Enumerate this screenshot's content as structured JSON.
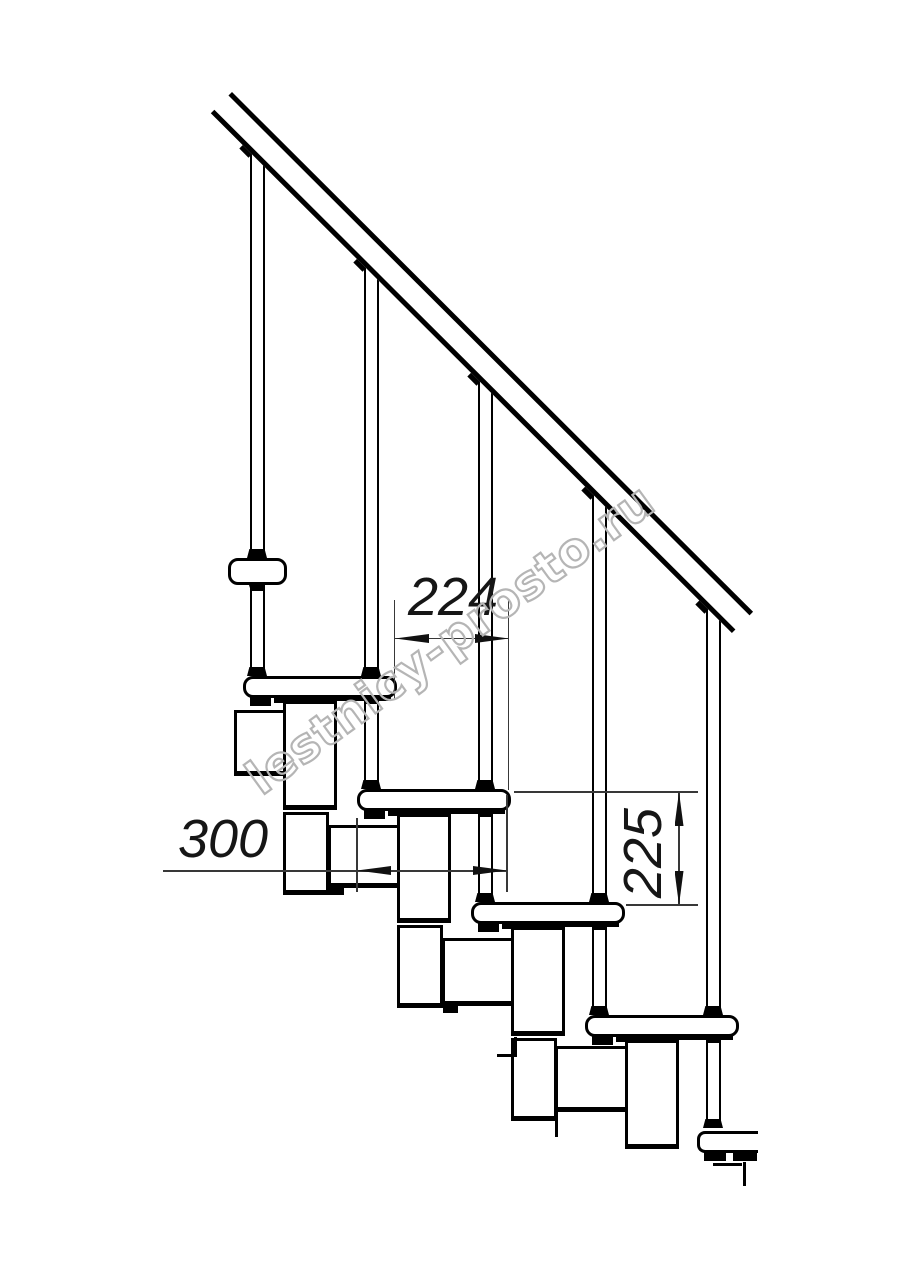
{
  "watermark": {
    "text": "lestnicy-prosto.ru"
  },
  "dimensions": [
    {
      "id": "dim-224",
      "value": "224",
      "orientation": "horizontal"
    },
    {
      "id": "dim-300",
      "value": "300",
      "orientation": "horizontal"
    },
    {
      "id": "dim-225",
      "value": "225",
      "orientation": "vertical"
    }
  ],
  "structure": {
    "balusters": 5,
    "treads_visible": 6,
    "handrail": true
  },
  "colors": {
    "line": "#000000",
    "dimension": "#383838",
    "watermark": "#b5b5b5",
    "background": "#ffffff"
  }
}
